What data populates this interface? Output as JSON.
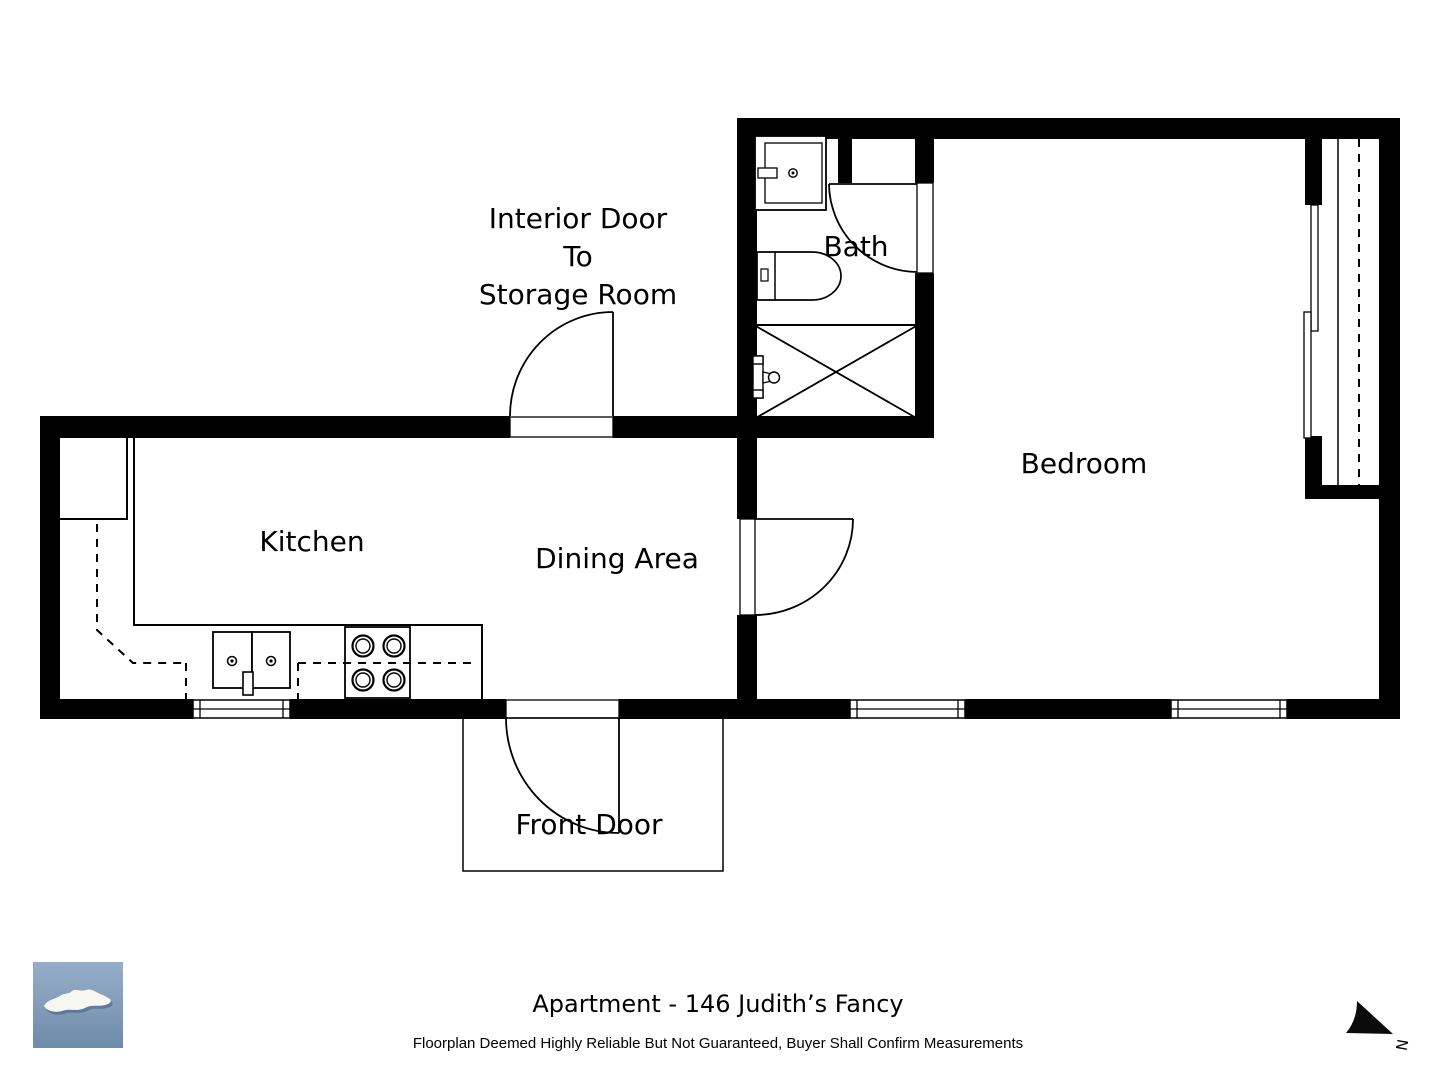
{
  "colors": {
    "wall": "#000000",
    "background": "#ffffff",
    "line": "#000000",
    "logo_blue_top": "#97aec9",
    "logo_blue_bottom": "#6e8baa",
    "logo_island": "#f7f7f2",
    "logo_island_shadow": "#41608a"
  },
  "rooms": {
    "kitchen": "Kitchen",
    "dining": "Dining Area",
    "bedroom": "Bedroom",
    "bath": "Bath"
  },
  "annotations": {
    "interior_door_line1": "Interior Door",
    "interior_door_line2": "To",
    "interior_door_line3": "Storage Room",
    "front_door": "Front Door"
  },
  "footer": {
    "title": "Apartment - 146 Judith’s Fancy",
    "disclaimer": "Floorplan Deemed Highly Reliable But Not Guaranteed, Buyer Shall Confirm Measurements"
  },
  "compass": {
    "north": "N"
  }
}
